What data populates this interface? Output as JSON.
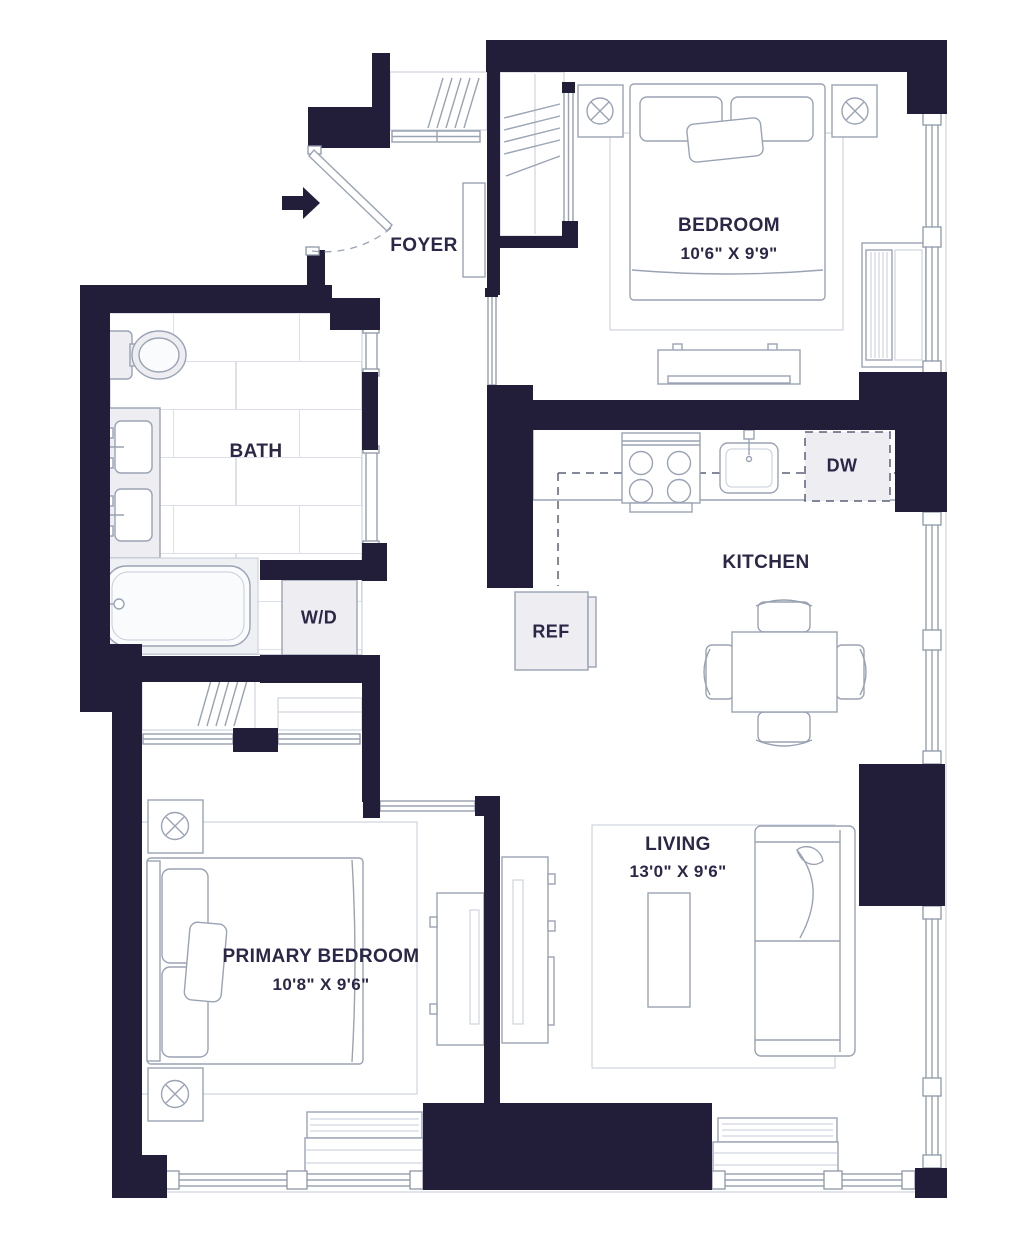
{
  "page": {
    "type": "floor-plan"
  },
  "colors": {
    "wall": "#221e3a",
    "furniture_line": "#9aa3b4",
    "light_line": "#c6ccd8",
    "tile_line": "#dde0e9",
    "text": "#2b2747",
    "appliance_fill": "#ededf2",
    "dash_line": "#5a6078"
  },
  "rooms": {
    "foyer": {
      "label": "FOYER"
    },
    "bedroom": {
      "label": "BEDROOM",
      "dimensions": "10'6\" X 9'9\""
    },
    "bath": {
      "label": "BATH"
    },
    "kitchen": {
      "label": "KITCHEN"
    },
    "living": {
      "label": "LIVING",
      "dimensions": "13'0\" X 9'6\""
    },
    "primary_bedroom": {
      "label": "PRIMARY BEDROOM",
      "dimensions": "10'8\" X 9'6\""
    }
  },
  "appliances": {
    "washer_dryer": {
      "label": "W/D"
    },
    "dishwasher": {
      "label": "DW"
    },
    "refrigerator": {
      "label": "REF"
    }
  }
}
